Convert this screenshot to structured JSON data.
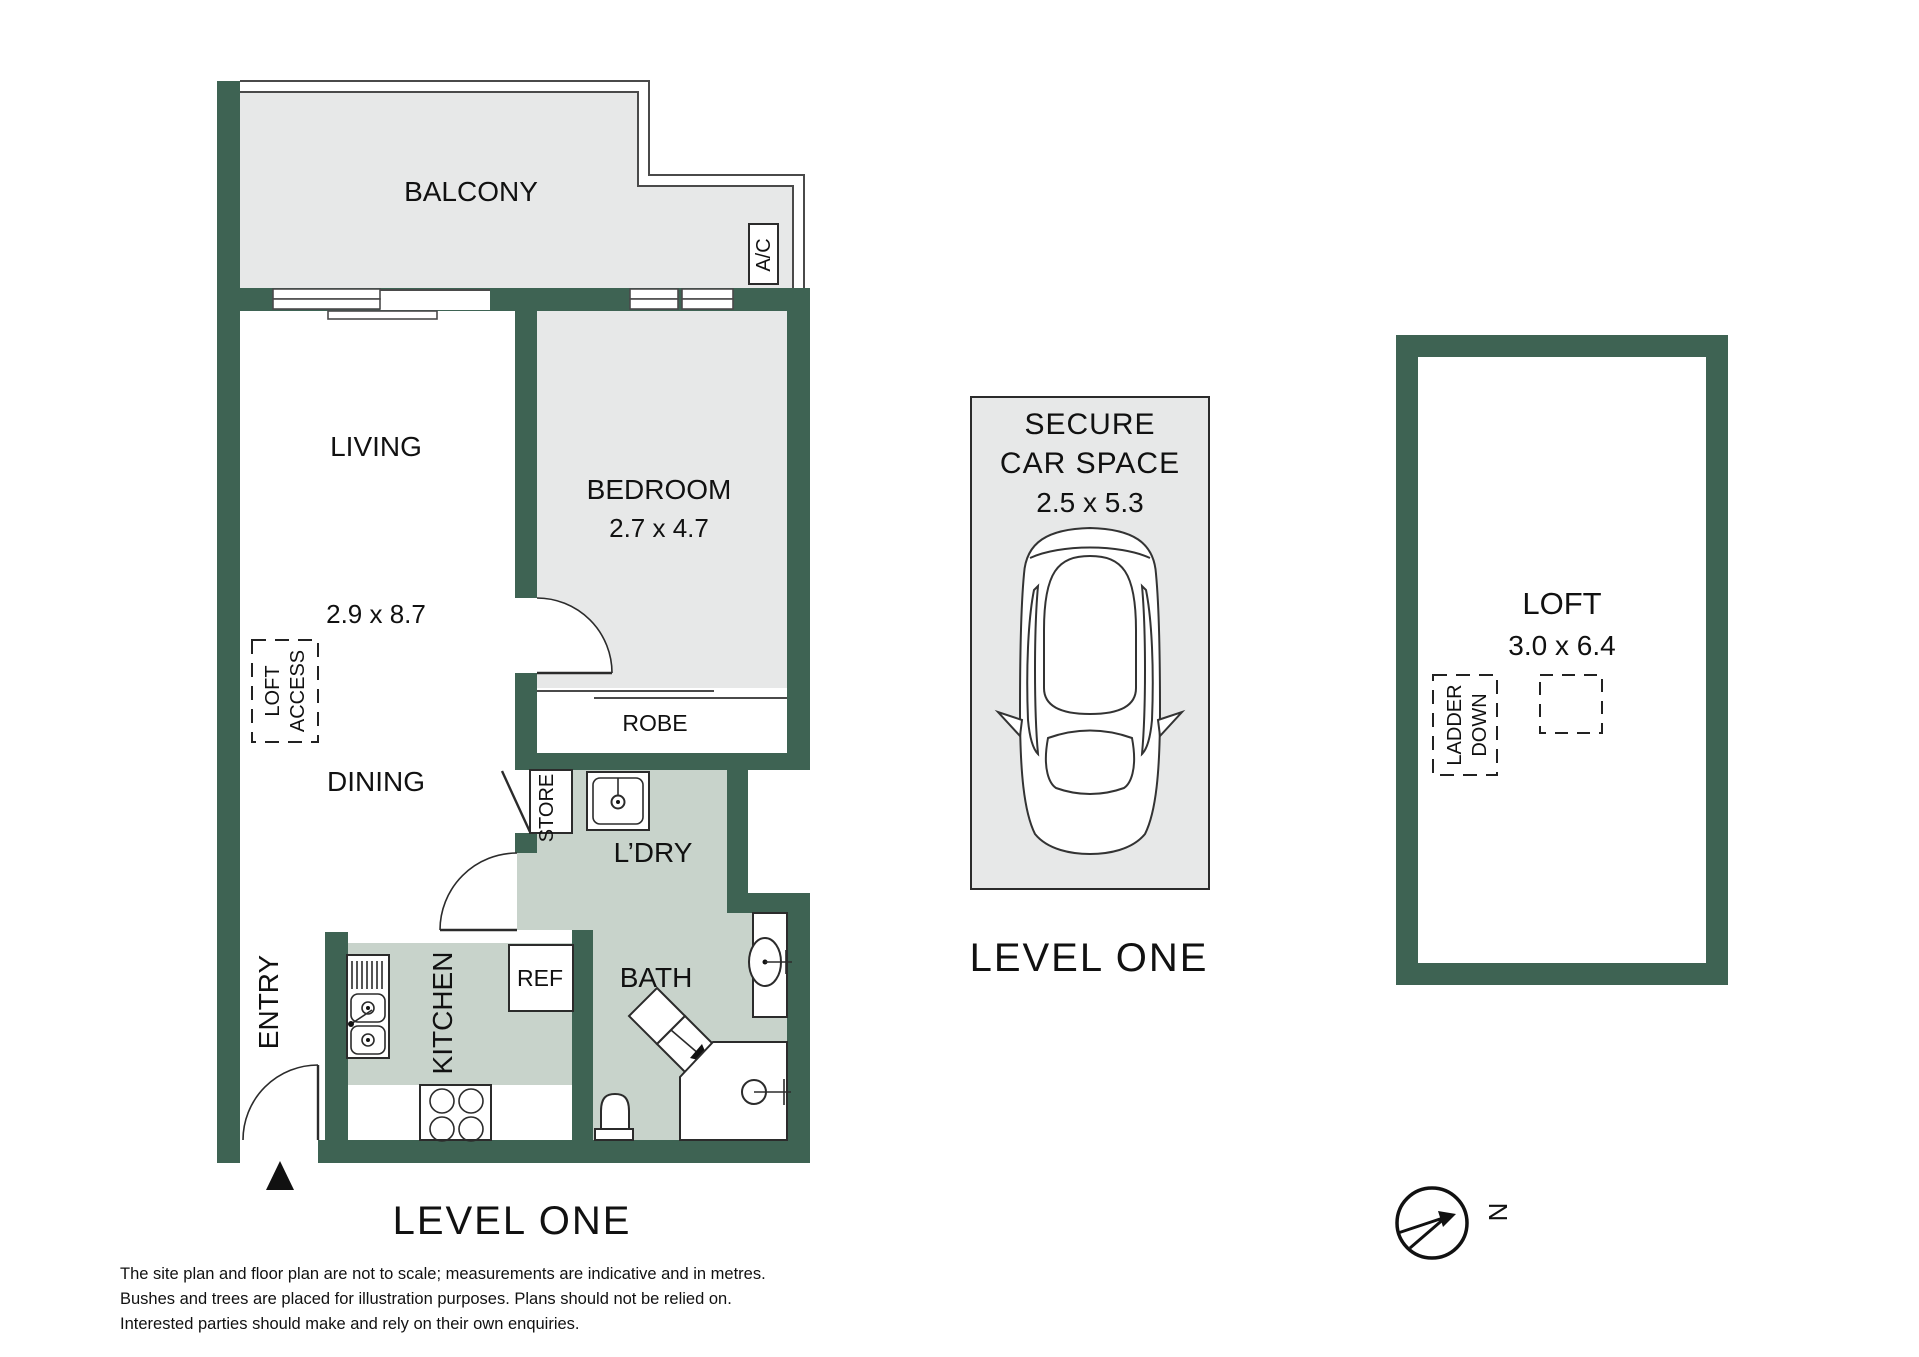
{
  "colors": {
    "wall": "#3e6353",
    "light_fill": "#e7e8e8",
    "wet_fill": "#c8d3cb",
    "line": "#4a4a4a",
    "text": "#111111"
  },
  "plan": {
    "level_label": "LEVEL ONE",
    "rooms": {
      "balcony": {
        "label": "BALCONY"
      },
      "living": {
        "label": "LIVING",
        "dimensions": "2.9 x 8.7"
      },
      "dining": {
        "label": "DINING"
      },
      "bedroom": {
        "label": "BEDROOM",
        "dimensions": "2.7 x 4.7"
      },
      "robe": {
        "label": "ROBE"
      },
      "laundry": {
        "label": "L’DRY"
      },
      "bath": {
        "label": "BATH"
      },
      "kitchen": {
        "label": "KITCHEN"
      },
      "entry": {
        "label": "ENTRY"
      },
      "store": {
        "label": "STORE"
      },
      "fridge": {
        "label": "REF"
      },
      "air_conditioner": {
        "label": "A/C"
      },
      "loft_access": {
        "line1": "LOFT",
        "line2": "ACCESS"
      }
    }
  },
  "car_space": {
    "title_line1": "SECURE",
    "title_line2": "CAR SPACE",
    "dimensions": "2.5 x 5.3",
    "level_label": "LEVEL ONE"
  },
  "loft": {
    "label": "LOFT",
    "dimensions": "3.0 x 6.4",
    "ladder_down": {
      "line1": "LADDER",
      "line2": "DOWN"
    }
  },
  "compass": {
    "north": "N"
  },
  "disclaimer": {
    "line1": "The site plan and floor plan are not to scale; measurements are indicative and in metres.",
    "line2": "Bushes and trees are placed for illustration purposes. Plans should not be relied on.",
    "line3": "Interested parties should make and rely on their own enquiries."
  }
}
